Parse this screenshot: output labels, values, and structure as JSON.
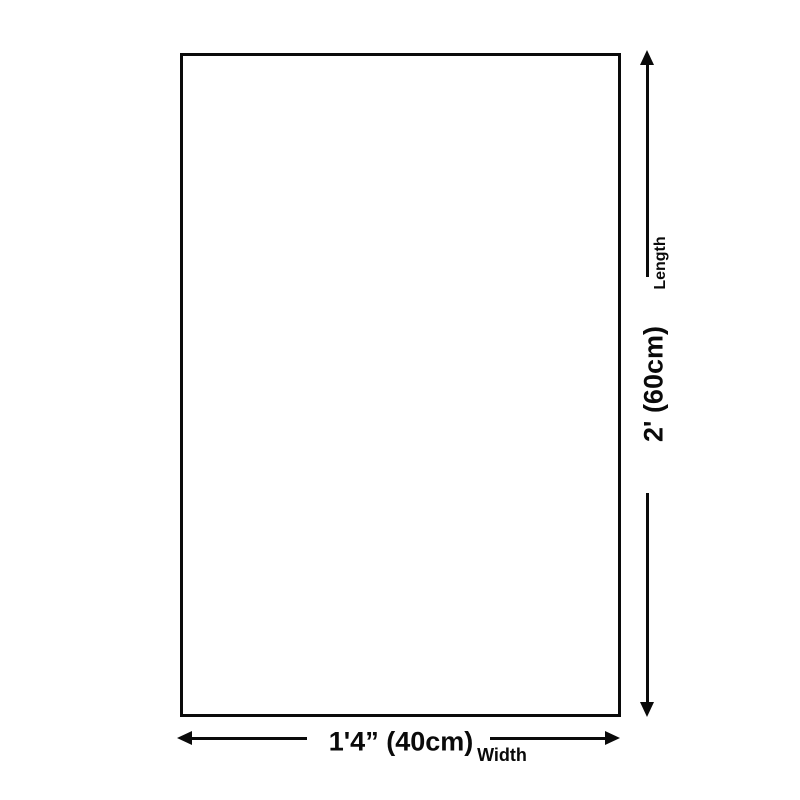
{
  "diagram": {
    "shape": "rectangle",
    "background_color": "#ffffff",
    "line_color": "#0a0a0a",
    "vertical_dimension": {
      "axis_label": "Length",
      "value": "2' (60cm)"
    },
    "horizontal_dimension": {
      "axis_label": "Width",
      "value": "1'4” (40cm)"
    }
  }
}
